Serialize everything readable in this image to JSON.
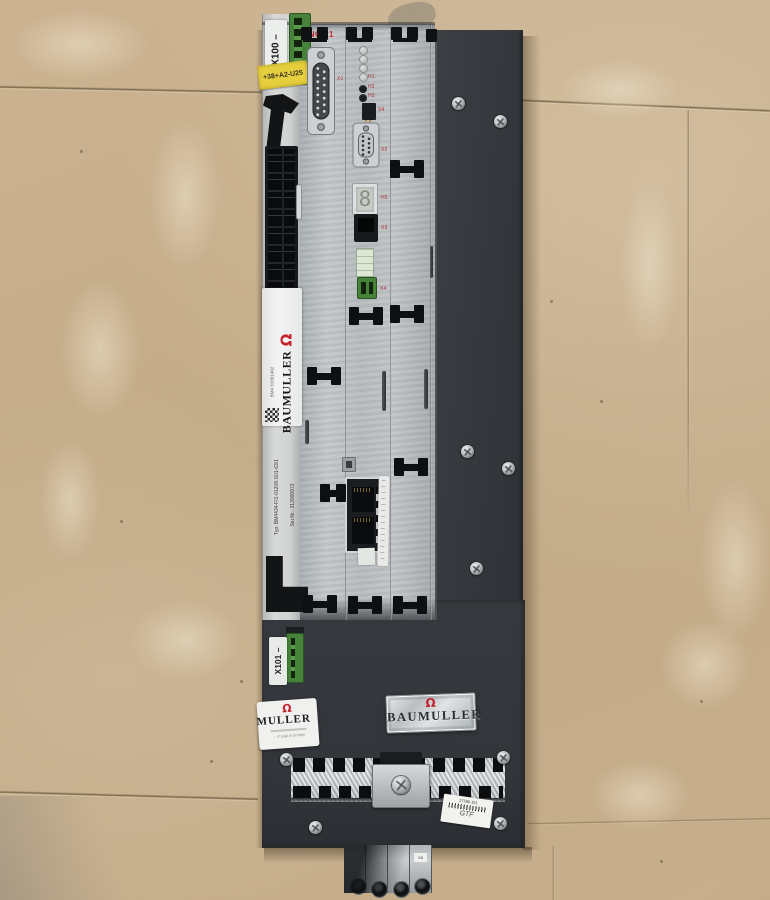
{
  "scene": {
    "description": "Photo of a Baumüller servo drive axis module lying on a concrete workshop floor",
    "colors": {
      "floor": "#c6ae8c",
      "chassis": "#34373c",
      "faceplate": "#b9bdc0",
      "brand_red": "#c3242e",
      "terminal_green": "#47823a",
      "tag_yellow": "#e6cf3e"
    },
    "icons": {
      "logo_glyph": "Ω"
    }
  },
  "left_strip": {
    "x100_label": "X100  –",
    "equipment_tag": "+38+A2-U25",
    "brand_label": {
      "brand": "BAUMULLER",
      "small_text": "BM4 31001402"
    },
    "type_label": {
      "typ": "Typ:   BM4434-FI1-01208-S01-63/1",
      "serial": "Ser.Nr.:   313000972"
    }
  },
  "module": {
    "option_tag": "ENC-21",
    "display_digit": "8",
    "refs": {
      "x1": "X1",
      "x2": "X2",
      "x3": "X3",
      "x4": "X4",
      "s4": "S4",
      "h5": "H5"
    },
    "leds": [
      "H1",
      "H2",
      "H3"
    ]
  },
  "bottom": {
    "x101_label": "X101  –",
    "label_left": {
      "brand_partial": "MULLER",
      "note": "… if seal is broken"
    },
    "label_right": {
      "brand": "BAUMULLER"
    },
    "sticker": {
      "line1": "17786 101",
      "line2": "GTF"
    },
    "terminal_ref": "X6"
  }
}
